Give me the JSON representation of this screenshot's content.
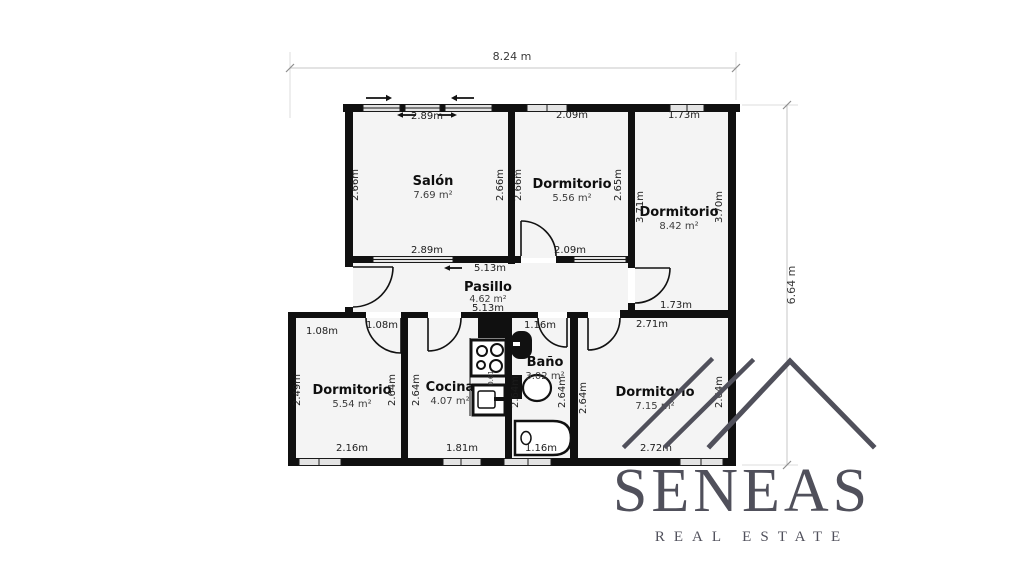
{
  "dimensions": {
    "width_label": "8.24 m",
    "height_label": "6.64 m"
  },
  "rooms": [
    {
      "name": "Salón",
      "area": "7.69 m²",
      "width_top": "2.89m",
      "width_bottom": "2.89m",
      "height_left": "2.66m",
      "height_right": "2.66m"
    },
    {
      "name": "Dormitorio",
      "area": "5.56 m²",
      "width_top": "2.09m",
      "width_bottom": "2.09m",
      "height_left": "2.66m",
      "height_right": "2.65m"
    },
    {
      "name": "Dormitorio",
      "area": "8.42 m²",
      "width_top": "1.73m",
      "width_bottom": "1.73m",
      "height_left": "3.71m",
      "height_right": "3.70m"
    },
    {
      "name": "Pasillo",
      "area": "4.62 m²",
      "width_top": "5.13m",
      "width_bottom": "5.13m"
    },
    {
      "name": "Dormitorio",
      "area": "5.54 m²",
      "width_top_left": "1.08m",
      "door_width": "1.08m",
      "width_bottom": "2.16m",
      "height_left": "2.49m",
      "height_right": "2.64m"
    },
    {
      "name": "Cocina",
      "area": "4.07 m²",
      "width_bottom": "1.81m",
      "height_left": "2.64m",
      "appliance_width": "0.61"
    },
    {
      "name": "Baño",
      "area": "3.02 m²",
      "width_top": "1.16m",
      "width_bottom": "1.16m",
      "height_left": "2.64m",
      "height_right": "2.64m"
    },
    {
      "name": "Dormitorio",
      "area": "7.15 m²",
      "width_top": "2.71m",
      "width_bottom": "2.72m",
      "height_left": "2.64m",
      "height_right": "2.64m"
    }
  ],
  "branding": {
    "name": "SENEAS",
    "tagline": "REAL ESTATE",
    "color": "#50505b"
  },
  "colors": {
    "wall": "#101010",
    "floor": "#f4f4f4"
  }
}
